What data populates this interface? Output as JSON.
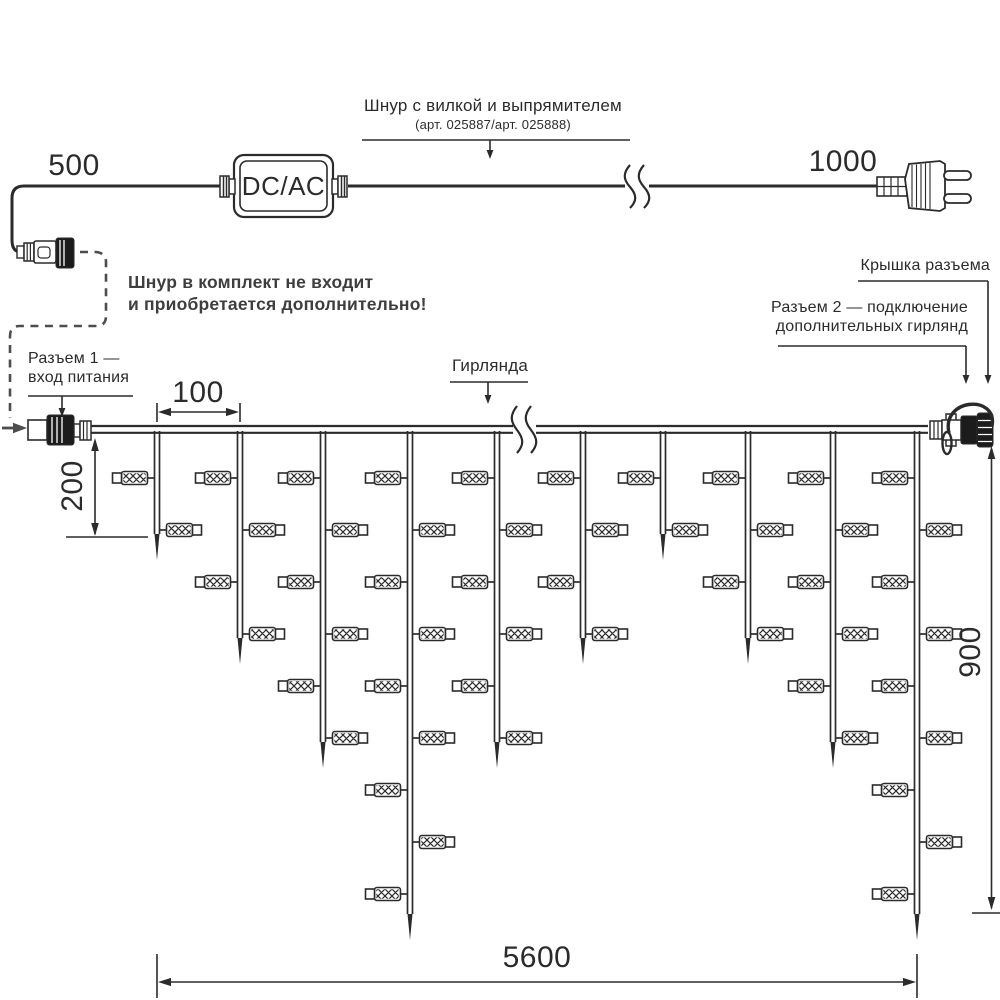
{
  "labels": {
    "cord_title": "Шнур с вилкой и выпрямителем",
    "cord_subtitle": "(арт. 025887/арт. 025888)",
    "converter": "DC/AC",
    "not_included_line1": "Шнур в комплект не входит",
    "not_included_line2": "и приобретается дополнительно!",
    "connector1_line1": "Разъем 1 —",
    "connector1_line2": "вход питания",
    "garland": "Гирлянда",
    "cap": "Крышка разъема",
    "connector2_line1": "Разъем 2 — подключение",
    "connector2_line2": "дополнительных гирлянд"
  },
  "dimensions": {
    "cord_left": "500",
    "cord_right": "1000",
    "drop_spacing": "100",
    "first_drop": "200",
    "drop_height": "900",
    "garland_length": "5600"
  },
  "colors": {
    "line": "#2b2b2b",
    "note_text": "#3e3e3e",
    "dash": "#4d4d4d",
    "background": "#ffffff"
  },
  "garland": {
    "wire_y": 425,
    "wire_x1": 90,
    "wire_x2": 928,
    "led_row_start": 478,
    "led_row_spacing": 52,
    "strands": [
      {
        "x": 157,
        "leds": 2,
        "tip": 560
      },
      {
        "x": 240,
        "leds": 4,
        "tip": 664
      },
      {
        "x": 323,
        "leds": 6,
        "tip": 768
      },
      {
        "x": 410,
        "leds": 9,
        "tip": 940
      },
      {
        "x": 497,
        "leds": 6,
        "tip": 768
      },
      {
        "x": 583,
        "leds": 4,
        "tip": 664
      },
      {
        "x": 663,
        "leds": 2,
        "tip": 560
      },
      {
        "x": 748,
        "leds": 4,
        "tip": 664
      },
      {
        "x": 833,
        "leds": 6,
        "tip": 768
      },
      {
        "x": 917,
        "leds": 9,
        "tip": 940
      }
    ]
  }
}
